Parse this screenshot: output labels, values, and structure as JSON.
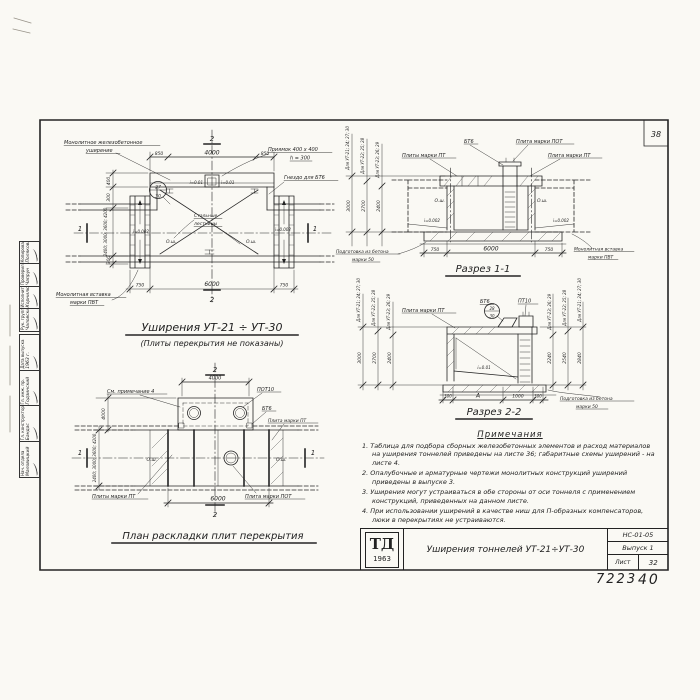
{
  "sheet": {
    "corner_number": "38",
    "footer_left": "7223",
    "footer_right": "40"
  },
  "plan_top": {
    "title": "Уширения УТ-21 ÷ УТ-30",
    "subtitle": "(Плиты перекрытия не показаны)",
    "label_widening_1": "Монолитное железобетонное",
    "label_widening_2": "уширение",
    "label_pit_1": "Приямок 400 х 400",
    "label_pit_2": "h = 300",
    "label_socket": "Гнездо для БТ6",
    "label_ladders_1": "Стальные",
    "label_ladders_2": "лестницы",
    "label_insert_1": "Монолитная вставка",
    "label_insert_2": "марки ПВТ",
    "callout_top": "27",
    "callout_bottom": "30",
    "slope_small": "i=0.01",
    "slope_left": "i=0.002",
    "slope_right": "i=0.002",
    "axis_seam": "О.ш.",
    "dim_top_left": "850",
    "dim_top_mid": "4000",
    "dim_top_right": "850",
    "dim_left_1": "400",
    "dim_left_2": "300",
    "dim_left_3": "2400; 3000; 3600; 4200",
    "dim_left_4": "300",
    "dim_bot_left": "750",
    "dim_bot_mid": "6000",
    "dim_bot_right": "750",
    "mark_1": "1",
    "mark_2": "2"
  },
  "section_1": {
    "title": "Разрез 1-1",
    "label_bt6": "БТ6",
    "label_plate_pot": "Плита марки ПОТ",
    "label_plates_pt": "Плиты марки ПТ",
    "label_plate_pt": "Плита марки ПТ",
    "label_prep_1": "Подготовка из бетона",
    "label_prep_2": "марки 50",
    "label_insert_1": "Монолитная вставка",
    "label_insert_2": "марки ПВТ",
    "slope_left": "i=0.002",
    "slope_right": "i=0.002",
    "axis_seam": "О.ш.",
    "dims_left": [
      {
        "label": "Для УТ-21; 24; 27; 30",
        "value": "3000"
      },
      {
        "label": "Для УТ-22; 25; 28",
        "value": "2700"
      },
      {
        "label": "Для УТ-23; 26; 29",
        "value": "2400"
      }
    ],
    "dim_bot_left": "750",
    "dim_bot_mid": "6000",
    "dim_bot_right": "750"
  },
  "section_2": {
    "title": "Разрез 2-2",
    "label_plate_pt": "Плита марки ПТ",
    "label_bt6": "БТ6",
    "label_pt10": "ПТ10",
    "callout_top": "28",
    "callout_bottom": "30",
    "slope": "i=0.01",
    "label_prep_1": "Подготовка из бетона",
    "label_prep_2": "марки 50",
    "dims_left": [
      {
        "label": "Для УТ-21; 24; 27; 30",
        "value": "3000"
      },
      {
        "label": "Для УТ-22; 25; 28",
        "value": "2700"
      },
      {
        "label": "Для УТ-23; 26; 29",
        "value": "2400"
      }
    ],
    "dims_right": [
      {
        "label": "Для УТ-23; 26; 29",
        "value": "2240"
      },
      {
        "label": "Для УТ-22; 25; 28",
        "value": "2540"
      },
      {
        "label": "Для УТ-21; 24; 27; 30",
        "value": "2840"
      }
    ],
    "dim_bot_1": "300",
    "dim_bot_2": "А",
    "dim_bot_3": "1000",
    "dim_bot_4": "300"
  },
  "plan_bottom": {
    "title": "План раскладки плит перекрытия",
    "label_note": "См. примечание 4",
    "label_pot10": "ПОТ10",
    "label_bt6": "БТ6",
    "label_plate_pt": "Плита марки ПТ",
    "label_plates_pt": "Плиты марки ПТ",
    "label_plate_pot": "Плита марки ПОТ",
    "axis_seam": "О.ш.",
    "dim_top": "4000",
    "dim_bottom": "6000",
    "dim_left_top": "4000",
    "dim_left_main": "2400; 3000; 3600; 4200",
    "mark_1": "1",
    "mark_2": "2"
  },
  "notes": {
    "title": "Примечания",
    "items": [
      "1. Таблица для подбора сборных железобетонных элементов и расход материалов на уширения тоннелей приведены на листе 36; габаритные схемы уширений - на листе 4.",
      "2. Опалубочные и арматурные чертежи монолитных конструкций уширений приведены в выпуске 3.",
      "3. Уширения могут устраиваться в обе стороны от оси тоннеля с применением конструкций, приведенных на данном листе.",
      "4. При использовании уширений в качестве ниш для П-образных компенсаторов, люки в перекрытиях не устраиваются."
    ]
  },
  "title_block": {
    "logo_top": "ТД",
    "logo_year": "1963",
    "drawing_title": "Уширения тоннелей УТ-21÷УТ-30",
    "doc_code": "НС-01-05",
    "issue": "Выпуск 1",
    "sheet_label": "Лист",
    "sheet_number": "32"
  },
  "stamps": {
    "group1": [
      {
        "role": "Рук. группы",
        "name": "Чаловский"
      },
      {
        "role": "Исполнитель",
        "name": "Корнилюк"
      },
      {
        "role": "Проверил",
        "name": "Чапрун"
      },
      {
        "role": "Копировал",
        "name": "Полякова"
      }
    ],
    "group2": [
      {
        "role": "Нач. отдела",
        "name": "Маловицкий"
      },
      {
        "role": "Гл. конструктор",
        "name": "Бандас"
      },
      {
        "role": "Гл. инж. пр.",
        "name": "Годзинский"
      },
      {
        "role": "Дата выпуска",
        "name": "1963 г."
      }
    ]
  }
}
